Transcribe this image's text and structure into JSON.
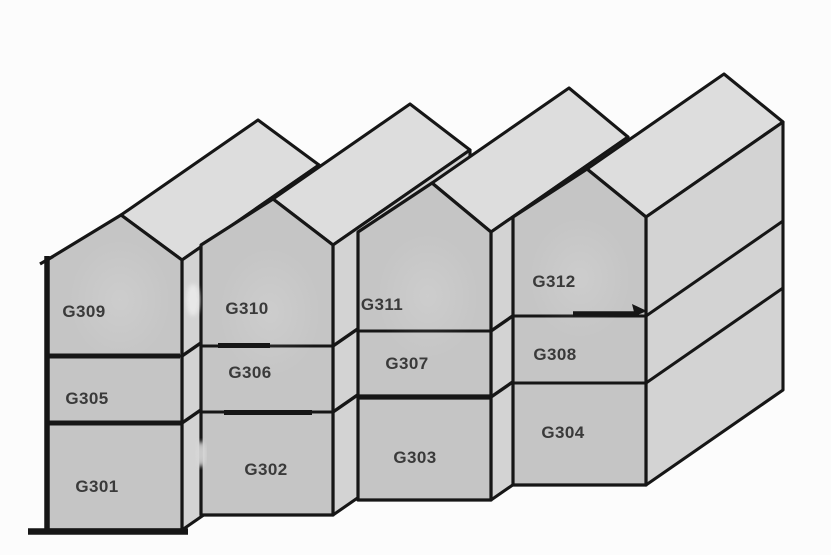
{
  "diagram": {
    "type": "isometric-building-units",
    "houses": [
      {
        "name": "house-1",
        "units": [
          {
            "label": "G309"
          },
          {
            "label": "G305"
          },
          {
            "label": "G301"
          }
        ]
      },
      {
        "name": "house-2",
        "units": [
          {
            "label": "G310"
          },
          {
            "label": "G306"
          },
          {
            "label": "G302"
          }
        ]
      },
      {
        "name": "house-3",
        "units": [
          {
            "label": "G311"
          },
          {
            "label": "G307"
          },
          {
            "label": "G303"
          }
        ]
      },
      {
        "name": "house-4",
        "units": [
          {
            "label": "G312"
          },
          {
            "label": "G308"
          },
          {
            "label": "G304"
          }
        ]
      }
    ],
    "colors": {
      "background": "#fcfcfc",
      "front_face": "#c5c5c5",
      "roof": "#dddddd",
      "side_wall": "#d3d3d3",
      "outline": "#161616",
      "label_text": "#3a3a3a"
    },
    "annotations": {
      "arrow": {
        "at": "right end of G312/G308 divider",
        "direction": "right"
      }
    }
  }
}
